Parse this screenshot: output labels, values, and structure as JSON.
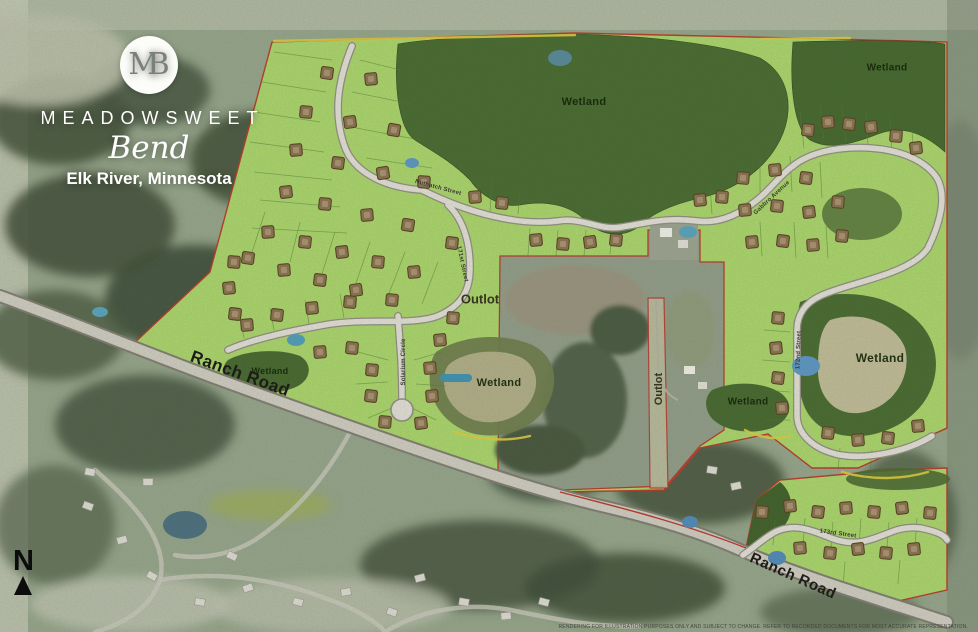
{
  "branding": {
    "monogram": "MB",
    "name": "MEADOWSWEET",
    "script_name": "Bend",
    "location": "Elk River, Minnesota"
  },
  "map": {
    "area_labels": {
      "wetland_top_center": "Wetland",
      "wetland_top_right": "Wetland",
      "wetland_west": "Wetland",
      "wetland_center": "Wetland",
      "wetland_center_right": "Wetland",
      "wetland_east": "Wetland",
      "outlot_center": "Outlot",
      "outlot_strip": "Outlot"
    },
    "road_labels": {
      "ranch_road_west": "Ranch Road",
      "ranch_road_east": "Ranch Road",
      "street_1": "Nuthatch Street",
      "street_2": "171st Street",
      "street_3": "Solarium Circle",
      "street_4": "Gabbro Avenue",
      "street_5": "172nd Street",
      "street_6": "173rd Street"
    },
    "north_label": "N",
    "disclaimer": "RENDERING FOR ILLUSTRATION PURPOSES ONLY AND SUBJECT TO CHANGE. REFER TO RECORDED DOCUMENTS FOR MOST ACCURATE REPRESENTATION."
  },
  "colors": {
    "plat_green": "#a8d169",
    "wetland_green": "#47682f",
    "boundary_red": "#b5382a",
    "road_gray": "#dedbd2",
    "pad_brown": "#8a6e50",
    "water_blue": "#5b93c0"
  }
}
